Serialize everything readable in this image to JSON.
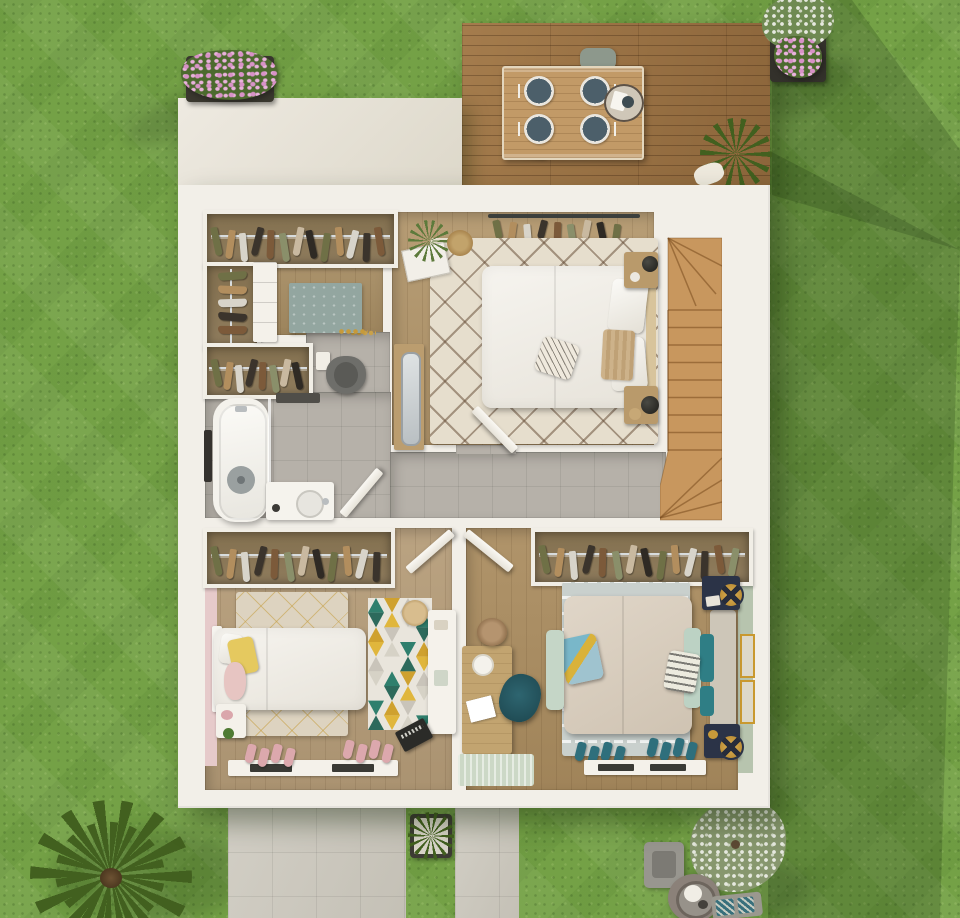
{
  "scene": {
    "description": "3D rendered top-down floor plan of an upper storey surrounded by a lawn, with a wooden terrace at the top and a paved driveway at the bottom",
    "visible_text": "none"
  },
  "palette": {
    "grass": "#74a146",
    "patio": "#ccc8bd",
    "deckWood": "#9a7143",
    "houseWhite": "#f2efe8",
    "tile": "#b6b1a9",
    "woodDressing": "#a68c62",
    "woodMaster": "#b2966b",
    "woodKids": "#b59c78",
    "woodBr": "#aa8c5f",
    "stairWood": "#c8975e",
    "rugMaster": "#e6decd",
    "rugKids": "#ddd3c0",
    "rugBlue": "#93a6a0",
    "rugBr": "#c9d0cd",
    "bedWhite": "#f2f0ea",
    "bedBeige": "#d9cebf",
    "mint": "#bcd2c4",
    "teal": "#2f7e85",
    "navy": "#2b3347",
    "gold": "#c9992f",
    "pinkWall": "#e6caca",
    "sageWall": "#b7c4ae",
    "clothesRail": "#d8dcdd",
    "pinkFlower": "#d892c7",
    "leafGreen": "#4c6a2e",
    "leafDark": "#42601f",
    "plate": "#4c5f6a",
    "chairSage": "#8d988c",
    "tableWood": "#c29a67",
    "headboardTan": "#d8c49c",
    "yellowPillow": "#e5c95f",
    "pinkPillow": "#e7c5c2",
    "chairTeal": "#235058",
    "deskWood": "#c2a470",
    "tealWcWall": "#24423c"
  },
  "exterior": {
    "lawn": {
      "label": "lawn"
    },
    "deck": {
      "label": "wooden terrace"
    },
    "dining_set": {
      "label": "outdoor dining table",
      "plates": 4,
      "chairs": 2,
      "tray": 1
    },
    "planter_top_left": {
      "label": "flower box with pink flowers"
    },
    "planter_top_right": {
      "label": "potted shrub with pink flowers"
    },
    "deck_grass_plant": {
      "label": "ornamental grass in pot"
    },
    "driveway": {
      "label": "paved driveway"
    },
    "path": {
      "label": "paved path"
    },
    "path_planter": {
      "label": "boxed shrub"
    },
    "palm": {
      "label": "palm plant"
    },
    "blossom_tree": {
      "label": "small blossom tree"
    },
    "fire_pit": {
      "label": "square fire table"
    },
    "side_table": {
      "label": "round garden table with plant"
    },
    "garden_bench": {
      "label": "garden seat with patterned cushions"
    }
  },
  "rooms": [
    {
      "id": "dressing",
      "label": "walk-in closet",
      "furniture": [
        "wardrobe with hanging clothes",
        "side wardrobe",
        "open shelf",
        "blue rug",
        "sandals"
      ]
    },
    {
      "id": "wc",
      "label": "toilet room",
      "furniture": [
        "wall-hung toilet",
        "cistern",
        "gold fittings",
        "dark green accent wall"
      ]
    },
    {
      "id": "bathroom",
      "label": "bathroom",
      "furniture": [
        "bathtub",
        "towel rail",
        "bath mat",
        "vanity with sink",
        "glass screen"
      ]
    },
    {
      "id": "master-bedroom",
      "label": "master bedroom",
      "furniture": [
        "double bed",
        "two nightstands with lamps",
        "open clothes rail",
        "berber rug",
        "standing mirror",
        "plant",
        "jute rug",
        "picture mat"
      ]
    },
    {
      "id": "landing",
      "label": "hallway landing",
      "furniture": []
    },
    {
      "id": "stairs",
      "label": "winder staircase",
      "furniture": []
    },
    {
      "id": "kids-bedroom",
      "label": "kids bedroom",
      "furniture": [
        "single bed",
        "nightstand",
        "wardrobe",
        "triangle rug",
        "desk",
        "stool",
        "laptop",
        "low shelf",
        "slippers"
      ]
    },
    {
      "id": "bedroom-2",
      "label": "second bedroom",
      "furniture": [
        "double bed with teal pillows",
        "bench",
        "two navy nightstands with gold lamps",
        "wardrobe",
        "ikat rug",
        "desk with chair",
        "pouf",
        "mint mat",
        "low shelf",
        "slippers",
        "gold framed art"
      ]
    }
  ],
  "generators": {
    "clothes_palette": [
      "#6f7046",
      "#b28e5e",
      "#d8d4ca",
      "#3b342c",
      "#7c5a3a",
      "#8a8f6a",
      "#c9b9a0",
      "#2f2a24"
    ],
    "wardrobes": {
      "dressing_top": {
        "count": 13
      },
      "dressing_side": {
        "count": 5,
        "vertical": true
      },
      "dressing_lower": {
        "count": 8
      },
      "master_rail": {
        "count": 9,
        "open": true
      },
      "kids": {
        "count": 12
      },
      "bedroom2": {
        "count": 14
      }
    },
    "stairs": {
      "straight_treads": 9,
      "top_winders": 3,
      "bottom_winders": 3
    },
    "triangle_rug": {
      "cols": 4,
      "rows": 9,
      "palette": [
        "#2f7f6d",
        "#cfa12f",
        "#c9c4ba",
        "#e9e5dc",
        "#2d6a5c",
        "#e0b63c",
        "#d6d2c6"
      ]
    },
    "slippers": {
      "kids_a": {
        "count": 4,
        "color": "#dca8ad"
      },
      "kids_b": {
        "count": 4,
        "color": "#dca8ad"
      },
      "bedroom2_a": {
        "count": 4,
        "color": "#2f6f7c"
      },
      "bedroom2_b": {
        "count": 4,
        "color": "#2f6f7c"
      }
    },
    "dining_plates": {
      "count": 4,
      "color": "#4c5f6a"
    }
  }
}
